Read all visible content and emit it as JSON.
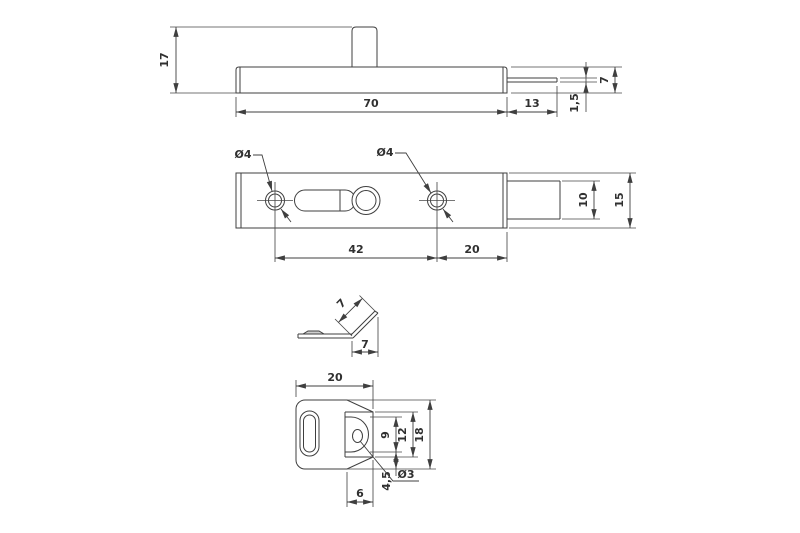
{
  "title": "Slide bolt technical drawing",
  "colors": {
    "line": "#3f3f3f",
    "text": "#303030",
    "background": "#ffffff"
  },
  "views": {
    "bolt_side": {
      "label": "bolt side elevation",
      "dims": {
        "total_height": "17",
        "body_length": "70",
        "bolt_extension": "13",
        "rod_thickness": "1,5",
        "body_height": "7"
      }
    },
    "bolt_plan": {
      "label": "bolt top view",
      "dims": {
        "hole_left_dia": "Ø4",
        "hole_right_dia": "Ø4",
        "hole_spacing": "42",
        "hole_to_edge": "20",
        "bolt_width": "10",
        "body_width": "15"
      }
    },
    "keeper_side": {
      "label": "keeper side view",
      "dims": {
        "flange_slant": "7",
        "flange_horizontal": "7"
      }
    },
    "keeper_plan": {
      "label": "keeper top view",
      "dims": {
        "plate_width": "20",
        "plate_height": "18",
        "opening_height": "12",
        "tongue_height": "9",
        "tongue_offset": "4,5",
        "fold_offset": "6",
        "hole_dia": "Ø3"
      }
    }
  }
}
